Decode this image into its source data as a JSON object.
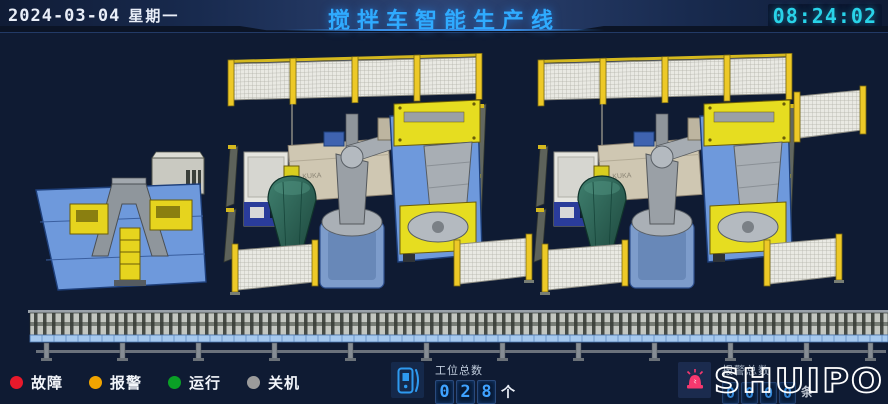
{
  "header": {
    "date": "2024-03-04",
    "weekday": "星期一",
    "title": "搅拌车智能生产线",
    "time": "08:24:02",
    "title_color": "#2fabff",
    "time_color": "#29d3e8"
  },
  "legend": {
    "items": [
      {
        "label": "故障",
        "color": "#e8192b"
      },
      {
        "label": "报警",
        "color": "#f0a400"
      },
      {
        "label": "运行",
        "color": "#0aa026"
      },
      {
        "label": "关机",
        "color": "#9b9b9b"
      }
    ]
  },
  "counters": {
    "stations": {
      "label": "工位总数",
      "digits": [
        "0",
        "2",
        "8"
      ],
      "unit": "个"
    },
    "alarms": {
      "label": "报警总数",
      "digits": [
        "0",
        "0",
        "0",
        "0"
      ],
      "unit": "条"
    }
  },
  "logo": {
    "text": "SHUIPO"
  },
  "scene": {
    "robot_brand": "KUKA",
    "colors": {
      "fence_yellow": "#edc927",
      "positioner_yellow": "#e6dd20",
      "machine_base_blue": "#6e99dc",
      "drum_green": "#2e6456",
      "alarm_beacon_pink": "#f5386e"
    }
  }
}
